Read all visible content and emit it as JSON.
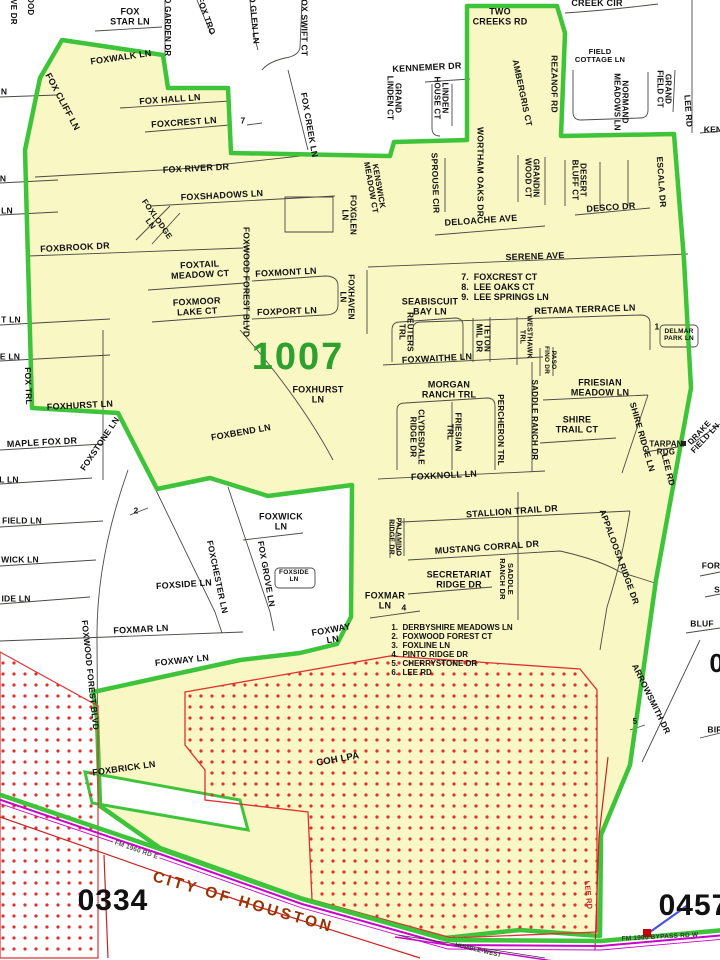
{
  "map": {
    "precinct_number": "1007",
    "adjacent_precinct_numbers": [
      "0334",
      "0457"
    ],
    "city_label": "CITY OF HOUSTON",
    "annexation_area_label": "COH LPA",
    "colors": {
      "precinct_fill": "#F9F7C3",
      "boundary_green": "#3EC43A",
      "precinct_number_green": "#2DA02D",
      "coh_overlay_red": "#E03030",
      "highway_magenta": "#CC00CC",
      "city_text_brown": "#993300",
      "marker_blue": "#4455DD",
      "street_line_gray": "#4A4A45",
      "lee_rd_red": "#CC2222"
    },
    "ref_lists": [
      {
        "x": 505,
        "y": 287,
        "s": 9,
        "lh": 1.12,
        "items": [
          "7.  FOXCREST CT",
          "8.  LEE OAKS CT",
          "9.  LEE SPRINGS LN"
        ]
      },
      {
        "x": 452,
        "y": 651,
        "s": 8,
        "lh": 1.12,
        "items": [
          "1.  DERBYSHIRE MEADOWS LN",
          "2.  FOXWOOD FOREST CT",
          "3.  FOXLINE LN",
          "4.  PINTO RIDGE DR",
          "5.  CHERRYSTONE DR",
          "6.  LEE RD"
        ]
      }
    ],
    "labels": [
      {
        "t": "FOX\nSTAR LN",
        "x": 130,
        "y": 17
      },
      {
        "t": "FOXWALK LN",
        "x": 121,
        "y": 58,
        "r": -8
      },
      {
        "t": "VE DR",
        "x": 13,
        "y": 12,
        "r": 90,
        "s": 8
      },
      {
        "t": "OOD",
        "x": 30,
        "y": 6,
        "r": 90,
        "s": 8
      },
      {
        "t": "D GARDEN DR",
        "x": 167,
        "y": 27,
        "r": 90,
        "s": 8
      },
      {
        "t": "FOX TRO",
        "x": 206,
        "y": 16,
        "r": 70,
        "s": 8.5
      },
      {
        "t": "O GLEN LN",
        "x": 254,
        "y": 20,
        "r": 85,
        "s": 8.5
      },
      {
        "t": "FOX SWIFT CT",
        "x": 304,
        "y": 25,
        "r": 90,
        "s": 8.5
      },
      {
        "t": "FOX CREEK LN",
        "x": 309,
        "y": 125,
        "r": 80,
        "s": 8.5
      },
      {
        "t": "FOX CLIFF LN",
        "x": 62,
        "y": 102,
        "r": 62
      },
      {
        "t": "FOX HALL LN",
        "x": 170,
        "y": 100,
        "r": -4
      },
      {
        "t": "FOXCREST LN",
        "x": 184,
        "y": 123,
        "r": -4
      },
      {
        "t": "7",
        "x": 243,
        "y": 121,
        "s": 8.5
      },
      {
        "t": "KENNEMER DR",
        "x": 427,
        "y": 68,
        "r": -3
      },
      {
        "t": "GRAND\nLINDEN CT",
        "x": 393,
        "y": 98,
        "r": 90,
        "s": 8
      },
      {
        "t": "LINDEN\nHOUSE CT",
        "x": 440,
        "y": 98,
        "r": 90,
        "s": 8
      },
      {
        "t": "TWO\nCREEKS RD",
        "x": 500,
        "y": 17
      },
      {
        "t": "CREEK CIR",
        "x": 597,
        "y": 4
      },
      {
        "t": "AMBERGRIS CT",
        "x": 522,
        "y": 93,
        "r": 78,
        "s": 8.5
      },
      {
        "t": "REZANOF RD",
        "x": 554,
        "y": 84,
        "r": 90,
        "s": 8.5
      },
      {
        "t": "FIELD\nCOTTAGE LN",
        "x": 600,
        "y": 56,
        "s": 7.5
      },
      {
        "t": "NORMAND\nMEADOWS LN",
        "x": 620,
        "y": 102,
        "r": 90,
        "s": 8
      },
      {
        "t": "GRAND\nFIELD CT",
        "x": 663,
        "y": 89,
        "r": 90,
        "s": 8
      },
      {
        "t": "LEE RD",
        "x": 688,
        "y": 111,
        "r": 86,
        "s": 8.5
      },
      {
        "t": "KEN",
        "x": 713,
        "y": 130,
        "s": 8.5
      },
      {
        "t": "KENSWICK\nMEADOW CT",
        "x": 374,
        "y": 187,
        "r": 80,
        "s": 8
      },
      {
        "t": "SPROUSE CIR",
        "x": 435,
        "y": 183,
        "r": 88,
        "s": 8.5
      },
      {
        "t": "WORTHAM OAKS DR",
        "x": 480,
        "y": 172,
        "r": 90,
        "s": 8.5
      },
      {
        "t": "GRANDIN\nWOOD CT",
        "x": 531,
        "y": 178,
        "r": 90,
        "s": 8
      },
      {
        "t": "DESERT\nBLUFF CT",
        "x": 578,
        "y": 180,
        "r": 90,
        "s": 8
      },
      {
        "t": "ESCALA DR",
        "x": 661,
        "y": 182,
        "r": 86,
        "s": 8.5
      },
      {
        "t": "DESCO DR",
        "x": 611,
        "y": 208,
        "r": -4
      },
      {
        "t": "DELOACHE AVE",
        "x": 481,
        "y": 221,
        "r": -4
      },
      {
        "t": "FOXGLEN\nLN",
        "x": 348,
        "y": 215,
        "r": 90,
        "s": 8
      },
      {
        "t": "FOX RIVER DR",
        "x": 196,
        "y": 169,
        "r": -3
      },
      {
        "t": "FOXSHADOWS LN",
        "x": 222,
        "y": 196,
        "r": -3
      },
      {
        "t": "FOXLODGE\nLN",
        "x": 153,
        "y": 222,
        "r": 55,
        "s": 8
      },
      {
        "t": "FOXBROOK DR",
        "x": 75,
        "y": 248,
        "r": -3
      },
      {
        "t": "FOXTAIL\nMEADOW CT",
        "x": 200,
        "y": 270,
        "r": -3
      },
      {
        "t": "FOXMOOR\nLAKE CT",
        "x": 197,
        "y": 307,
        "r": -3
      },
      {
        "t": "FOXWOOD FOREST BLVD",
        "x": 246,
        "y": 282,
        "r": 90,
        "s": 8.5
      },
      {
        "t": "FOXMONT LN",
        "x": 286,
        "y": 273,
        "r": -3
      },
      {
        "t": "FOXPORT LN",
        "x": 287,
        "y": 312,
        "r": -2
      },
      {
        "t": "FOXHAVEN\nLN",
        "x": 346,
        "y": 297,
        "r": 90,
        "s": 8
      },
      {
        "t": "SERENE AVE",
        "x": 535,
        "y": 257,
        "r": -2
      },
      {
        "t": "SEABISCUIT\nBAY LN",
        "x": 430,
        "y": 307
      },
      {
        "t": "REUTERS\nTRL",
        "x": 405,
        "y": 332,
        "r": 90,
        "s": 8
      },
      {
        "t": "TETON\nMIL DR",
        "x": 482,
        "y": 338,
        "r": 90,
        "s": 8
      },
      {
        "t": "WESTHAWK\nTRL",
        "x": 525,
        "y": 337,
        "r": 90,
        "s": 7
      },
      {
        "t": "RETAMA TERRACE LN",
        "x": 585,
        "y": 310,
        "r": -2
      },
      {
        "t": "1",
        "x": 657,
        "y": 327,
        "s": 8.5
      },
      {
        "t": "DELMAR\nPARK LN",
        "x": 679,
        "y": 336,
        "s": 6.5
      },
      {
        "t": "FOXWAITHE LN",
        "x": 437,
        "y": 359,
        "r": -3
      },
      {
        "t": "PASO\nFINO DR",
        "x": 549,
        "y": 360,
        "r": 90,
        "s": 6.5
      },
      {
        "t": "1007",
        "x": 298,
        "y": 357,
        "s": 38,
        "c": "#2DA02D",
        "ls": 2,
        "name": "precinct-number"
      },
      {
        "t": "FOXHURST\nLN",
        "x": 318,
        "y": 395
      },
      {
        "t": "MORGAN\nRANCH TRL",
        "x": 449,
        "y": 390
      },
      {
        "t": "FRIESIAN\nMEADOW LN",
        "x": 600,
        "y": 388
      },
      {
        "t": "CLYDESDALE\nRIDGE DR",
        "x": 416,
        "y": 437,
        "r": 90,
        "s": 8
      },
      {
        "t": "FRIESIAN\nTRL",
        "x": 453,
        "y": 432,
        "r": 90,
        "s": 8
      },
      {
        "t": "PERCHERON TRL",
        "x": 500,
        "y": 430,
        "r": 90,
        "s": 8
      },
      {
        "t": "SADDLE RANCH DR",
        "x": 534,
        "y": 420,
        "r": 90,
        "s": 8
      },
      {
        "t": "SHIRE\nTRAIL CT",
        "x": 577,
        "y": 425
      },
      {
        "t": "SHIRE RIDGE LN",
        "x": 642,
        "y": 437,
        "r": 74,
        "s": 8.5
      },
      {
        "t": "TARPAN\nRDG",
        "x": 666,
        "y": 449,
        "s": 8
      },
      {
        "t": "DRAKE\nFIELD LN",
        "x": 703,
        "y": 436,
        "r": -47,
        "s": 8
      },
      {
        "t": "LEE RD",
        "x": 668,
        "y": 470,
        "r": 76,
        "s": 8.5
      },
      {
        "t": "FOXHURST LN",
        "x": 80,
        "y": 406,
        "r": -3
      },
      {
        "t": "FOX TRL",
        "x": 28,
        "y": 386,
        "r": 88,
        "s": 8.5
      },
      {
        "t": "FOXSTONE LN",
        "x": 100,
        "y": 444,
        "r": -56,
        "s": 8.5
      },
      {
        "t": "MAPLE FOX DR",
        "x": 42,
        "y": 443,
        "r": -3
      },
      {
        "t": "FOXBEND LN",
        "x": 241,
        "y": 433,
        "r": -10
      },
      {
        "t": "FOXKNOLL LN",
        "x": 444,
        "y": 476,
        "r": -3
      },
      {
        "t": "STALLION TRAIL DR",
        "x": 512,
        "y": 512,
        "r": -4
      },
      {
        "t": "MUSTANG CORRAL DR",
        "x": 487,
        "y": 548,
        "r": -4
      },
      {
        "t": "SECRETARIAT\nRIDGE DR",
        "x": 459,
        "y": 580
      },
      {
        "t": "PALAMINO\nRIDGE DR",
        "x": 394,
        "y": 537,
        "r": 90,
        "s": 7
      },
      {
        "t": "SADDLE\nRANCH DR",
        "x": 506,
        "y": 579,
        "r": 90,
        "s": 7.5
      },
      {
        "t": "APPALOOSA RIDGE DR",
        "x": 619,
        "y": 557,
        "r": 70,
        "s": 8.5
      },
      {
        "t": "FOXMAR\nLN",
        "x": 385,
        "y": 601
      },
      {
        "t": "4",
        "x": 404,
        "y": 608,
        "s": 8.5
      },
      {
        "t": "2",
        "x": 136,
        "y": 511,
        "s": 8.5
      },
      {
        "t": "FOXWICK\nLN",
        "x": 281,
        "y": 522
      },
      {
        "t": "FOX GROVE LN",
        "x": 266,
        "y": 574,
        "r": 80,
        "s": 8.5
      },
      {
        "t": "FOXSIDE\nLN",
        "x": 294,
        "y": 577,
        "s": 6.5
      },
      {
        "t": "FOXCHESTER LN",
        "x": 217,
        "y": 577,
        "r": 78,
        "s": 8.5
      },
      {
        "t": "FOXSIDE LN",
        "x": 184,
        "y": 585,
        "r": -4
      },
      {
        "t": "FOXMAR LN",
        "x": 141,
        "y": 630,
        "r": -3
      },
      {
        "t": "FOXWAY LN",
        "x": 182,
        "y": 661,
        "r": -6
      },
      {
        "t": "FOXWAY\nLN",
        "x": 332,
        "y": 635,
        "r": -10
      },
      {
        "t": "FOXWOOD FOREST BLVD",
        "x": 90,
        "y": 675,
        "r": 84,
        "s": 8.5
      },
      {
        "t": "FOXBRICK LN",
        "x": 124,
        "y": 769,
        "r": -8
      },
      {
        "t": "COH LPA",
        "x": 338,
        "y": 760,
        "r": -10,
        "s": 9.5,
        "name": "annexation-area-label"
      },
      {
        "t": "ARROWSMITH DR",
        "x": 651,
        "y": 699,
        "r": 64,
        "s": 8.5
      },
      {
        "t": "5",
        "x": 635,
        "y": 722,
        "s": 8
      },
      {
        "t": "FOR",
        "x": 711,
        "y": 566,
        "s": 8.5
      },
      {
        "t": "S",
        "x": 717,
        "y": 590,
        "s": 8.5
      },
      {
        "t": "BLUF",
        "x": 702,
        "y": 624,
        "s": 8.5
      },
      {
        "t": "04",
        "x": 724,
        "y": 664,
        "s": 26,
        "name": "adjacent-precinct-number-partial"
      },
      {
        "t": "BIR",
        "x": 715,
        "y": 730,
        "s": 8.5
      },
      {
        "t": "N",
        "x": 4,
        "y": 92,
        "s": 8.5
      },
      {
        "t": "N",
        "x": 3,
        "y": 179,
        "s": 8.5
      },
      {
        "t": "LN",
        "x": 7,
        "y": 211,
        "s": 8.5
      },
      {
        "t": "T LN",
        "x": 11,
        "y": 320,
        "s": 8.5
      },
      {
        "t": "E LN",
        "x": 10,
        "y": 357,
        "s": 8.5
      },
      {
        "t": "L LN",
        "x": 9,
        "y": 480,
        "s": 8.5
      },
      {
        "t": "FIELD LN",
        "x": 22,
        "y": 521,
        "s": 8.5
      },
      {
        "t": "WICK LN",
        "x": 20,
        "y": 560,
        "s": 8.5
      },
      {
        "t": "IDE LN",
        "x": 16,
        "y": 599,
        "s": 8.5
      },
      {
        "t": "LEE RD",
        "x": 588,
        "y": 895,
        "r": 84,
        "s": 7.5,
        "c": "#CC2222"
      },
      {
        "t": "FM 1960 RD E",
        "x": 136,
        "y": 851,
        "r": 19,
        "s": 6.5,
        "c": "#555555",
        "bg": "#FFFFFF"
      },
      {
        "t": "CITY OF HOUSTON",
        "x": 243,
        "y": 903,
        "r": 16,
        "s": 15.5,
        "c": "#993300",
        "ls": 3,
        "name": "city-label"
      },
      {
        "t": "0334",
        "x": 113,
        "y": 901,
        "s": 30,
        "ls": 1,
        "name": "adjacent-precinct-number"
      },
      {
        "t": "0457",
        "x": 694,
        "y": 906,
        "s": 30,
        "ls": 1,
        "name": "adjacent-precinct-number"
      },
      {
        "t": "FM 1960 BYPASS RD W",
        "x": 660,
        "y": 938,
        "r": -3,
        "s": 6.5,
        "c": "#333333"
      },
      {
        "t": "HUMBLE-WEST",
        "x": 478,
        "y": 951,
        "r": 13,
        "s": 6,
        "c": "#333333"
      },
      {
        "t": "99",
        "x": 433,
        "y": -10,
        "s": 30,
        "name": "adjacent-precinct-number-partial"
      }
    ]
  }
}
